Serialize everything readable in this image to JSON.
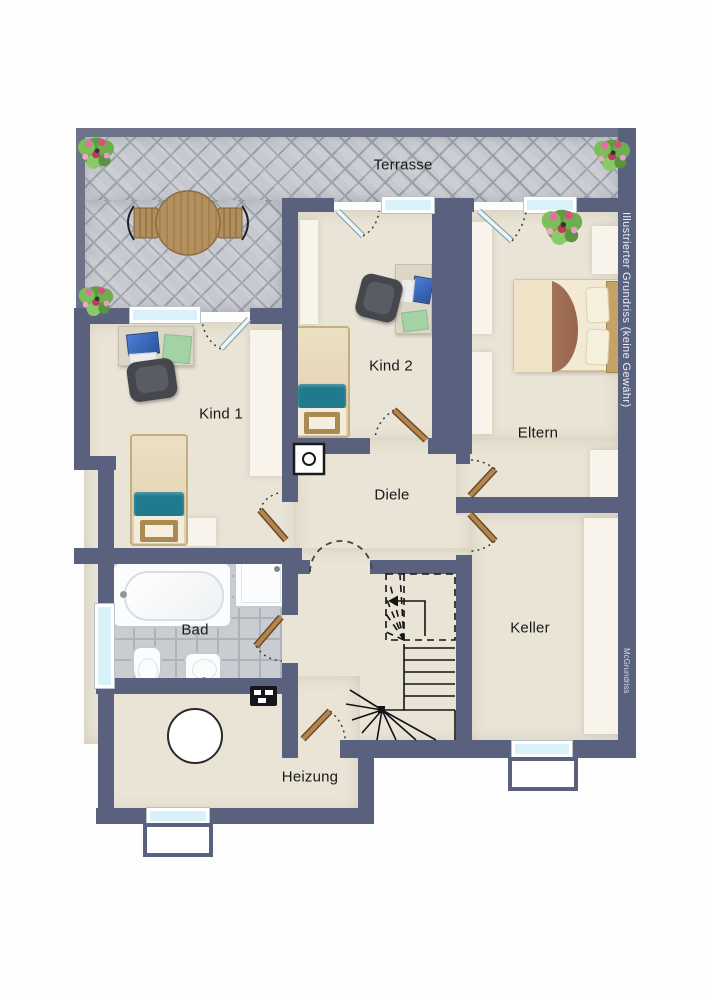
{
  "rooms": {
    "terrasse": {
      "label": "Terrasse"
    },
    "kind1": {
      "label": "Kind 1"
    },
    "kind2": {
      "label": "Kind 2"
    },
    "eltern": {
      "label": "Eltern"
    },
    "diele": {
      "label": "Diele"
    },
    "bad": {
      "label": "Bad"
    },
    "keller": {
      "label": "Keller"
    },
    "heizung": {
      "label": "Heizung"
    }
  },
  "watermarks": {
    "disclaimer": "Illustrierter Grundriss (keine Gewähr)",
    "brand": "McGrundriss"
  },
  "palette": {
    "wall": "#59617f",
    "terrace_border": "#6e7389",
    "floor": "#e9e4d6",
    "terrace_tile": "#c6c9cf",
    "terrace_line": "#9aa0a8",
    "bath_tile": "#c9cdd2",
    "bath_line": "#aeb3ba",
    "window": "#d9f2f9",
    "wood_door": "#b5854f",
    "wood_door_edge": "#6b4a26",
    "glass_door": "#eaf7fb",
    "teal": "#20798c",
    "label_color": "#191919",
    "watermark_color": "#edeef4"
  }
}
